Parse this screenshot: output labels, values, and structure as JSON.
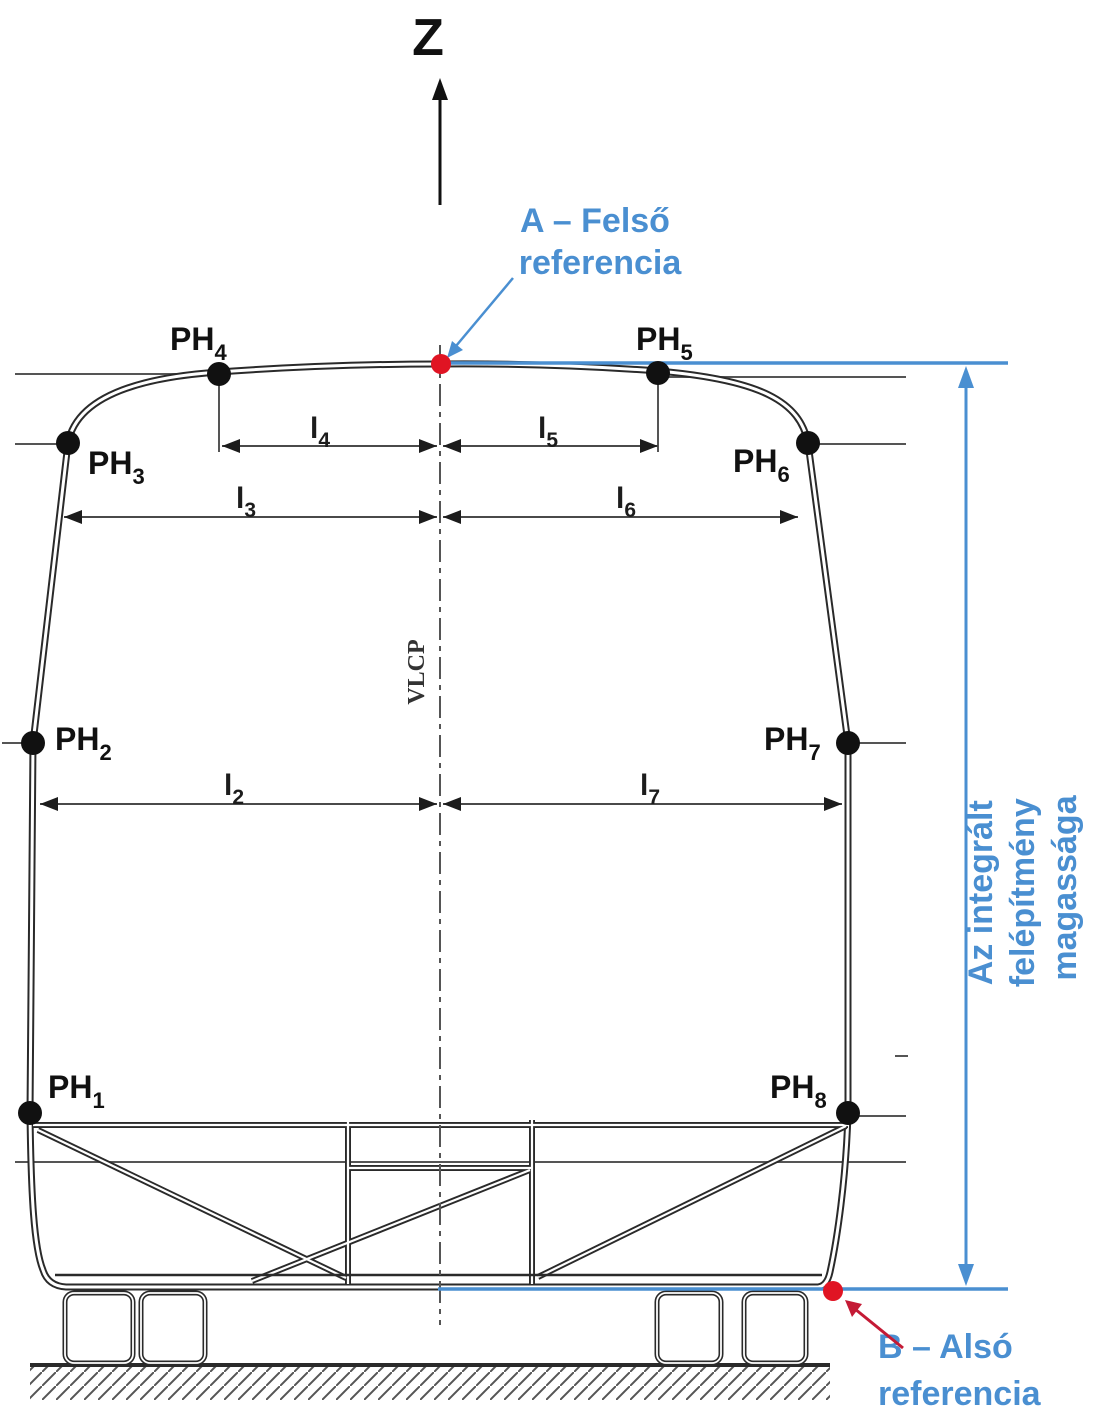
{
  "axis": {
    "z_label": "Z"
  },
  "centerline_label": "VLCP",
  "annotations": {
    "upper_ref": {
      "line1": "A – Felső",
      "line2": "referencia"
    },
    "lower_ref": {
      "line1": "B – Alsó",
      "line2": "referencia"
    },
    "height_label": {
      "line1": "Az integrált",
      "line2": "felépítmény",
      "line3": "magassága"
    }
  },
  "points": [
    {
      "base": "PH",
      "sub": "1"
    },
    {
      "base": "PH",
      "sub": "2"
    },
    {
      "base": "PH",
      "sub": "3"
    },
    {
      "base": "PH",
      "sub": "4"
    },
    {
      "base": "PH",
      "sub": "5"
    },
    {
      "base": "PH",
      "sub": "6"
    },
    {
      "base": "PH",
      "sub": "7"
    },
    {
      "base": "PH",
      "sub": "8"
    }
  ],
  "dimensions": [
    {
      "base": "l",
      "sub": "2"
    },
    {
      "base": "l",
      "sub": "3"
    },
    {
      "base": "l",
      "sub": "4"
    },
    {
      "base": "l",
      "sub": "5"
    },
    {
      "base": "l",
      "sub": "6"
    },
    {
      "base": "l",
      "sub": "7"
    }
  ],
  "colors": {
    "accent_blue": "#4a8fd1",
    "marker_red": "#e01423",
    "arrow_red": "#c41a35",
    "line_dark": "#2a2a2a",
    "line_gray": "#555555"
  }
}
